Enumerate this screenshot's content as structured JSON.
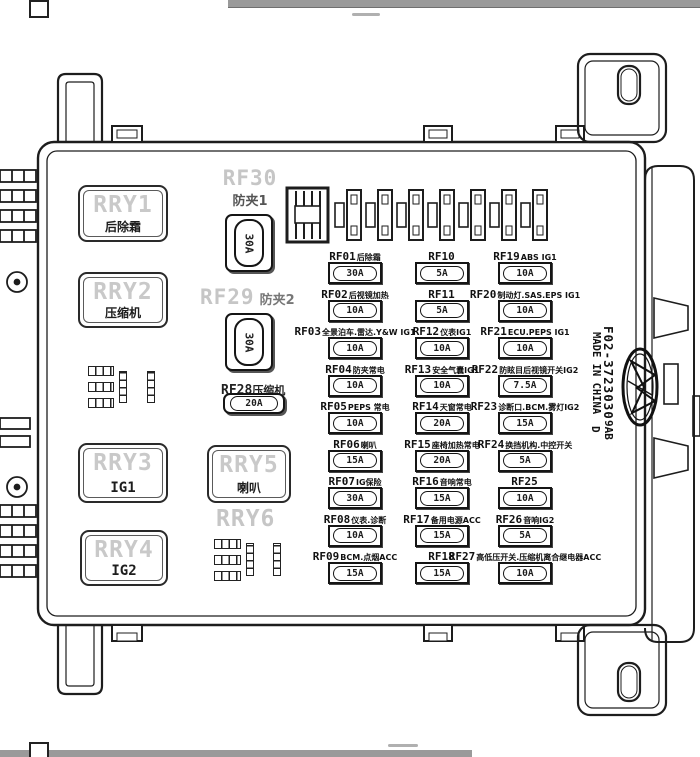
{
  "part_info": {
    "part_number": "F02-3723030",
    "made_in": "MADE IN CHINA",
    "code_right": "9AB",
    "code_left": "D"
  },
  "colors": {
    "line": "#1d1d1d",
    "ghost_text": "#c6c6c6",
    "watermark_bar": "#9a9a9a"
  },
  "relays": [
    {
      "id": "RRY1",
      "label": "后除霜"
    },
    {
      "id": "RRY2",
      "label": "压缩机"
    },
    {
      "id": "RRY3",
      "label": "IG1"
    },
    {
      "id": "RRY4",
      "label": "IG2"
    },
    {
      "id": "RRY5",
      "label": "喇叭"
    },
    {
      "id": "RRY6",
      "label": ""
    }
  ],
  "maxi_fuses": [
    {
      "id": "RF30",
      "label": "防夹1",
      "amp": "30A"
    },
    {
      "id": "RF29",
      "label": "防夹2",
      "amp": "30A"
    },
    {
      "id": "RF28",
      "label": "压缩机",
      "amp": "20A"
    }
  ],
  "fuse_columns": [
    {
      "fuses": [
        {
          "id": "RF01",
          "label": "后除霜",
          "amp": "30A"
        },
        {
          "id": "RF02",
          "label": "后视镜加热",
          "amp": "10A"
        },
        {
          "id": "RF03",
          "label": "全景泊车.雷达.Y&W IG1",
          "amp": "10A"
        },
        {
          "id": "RF04",
          "label": "防夹常电",
          "amp": "10A"
        },
        {
          "id": "RF05",
          "label": "PEPS 常电",
          "amp": "10A"
        },
        {
          "id": "RF06",
          "label": "喇叭",
          "amp": "15A"
        },
        {
          "id": "RF07",
          "label": "IG保险",
          "amp": "30A"
        },
        {
          "id": "RF08",
          "label": "仪表.诊断",
          "amp": "10A"
        },
        {
          "id": "RF09",
          "label": "BCM.点烟ACC",
          "amp": "15A"
        }
      ]
    },
    {
      "fuses": [
        {
          "id": "RF10",
          "label": "",
          "amp": "5A"
        },
        {
          "id": "RF11",
          "label": "",
          "amp": "5A"
        },
        {
          "id": "RF12",
          "label": "仪表IG1",
          "amp": "10A"
        },
        {
          "id": "RF13",
          "label": "安全气囊IG1",
          "amp": "10A"
        },
        {
          "id": "RF14",
          "label": "天窗常电",
          "amp": "20A"
        },
        {
          "id": "RF15",
          "label": "座椅加热常电",
          "amp": "20A"
        },
        {
          "id": "RF16",
          "label": "音响常电",
          "amp": "15A"
        },
        {
          "id": "RF17",
          "label": "备用电源ACC",
          "amp": "15A"
        },
        {
          "id": "RF18",
          "label": "",
          "amp": "15A"
        }
      ]
    },
    {
      "fuses": [
        {
          "id": "RF19",
          "label": "ABS IG1",
          "amp": "10A"
        },
        {
          "id": "RF20",
          "label": "制动灯.SAS.EPS IG1",
          "amp": "10A"
        },
        {
          "id": "RF21",
          "label": "ECU.PEPS IG1",
          "amp": "10A"
        },
        {
          "id": "RF22",
          "label": "防眩目后视镜开关IG2",
          "amp": "7.5A"
        },
        {
          "id": "RF23",
          "label": "诊断口.BCM.雾灯IG2",
          "amp": "15A"
        },
        {
          "id": "RF24",
          "label": "换挡机构.中控开关",
          "amp": "5A"
        },
        {
          "id": "RF25",
          "label": "",
          "amp": "10A"
        },
        {
          "id": "RF26",
          "label": "音响IG2",
          "amp": "5A"
        },
        {
          "id": "RF27",
          "label": "高低压开关.压缩机离合继电器ACC",
          "amp": "10A"
        }
      ]
    }
  ]
}
